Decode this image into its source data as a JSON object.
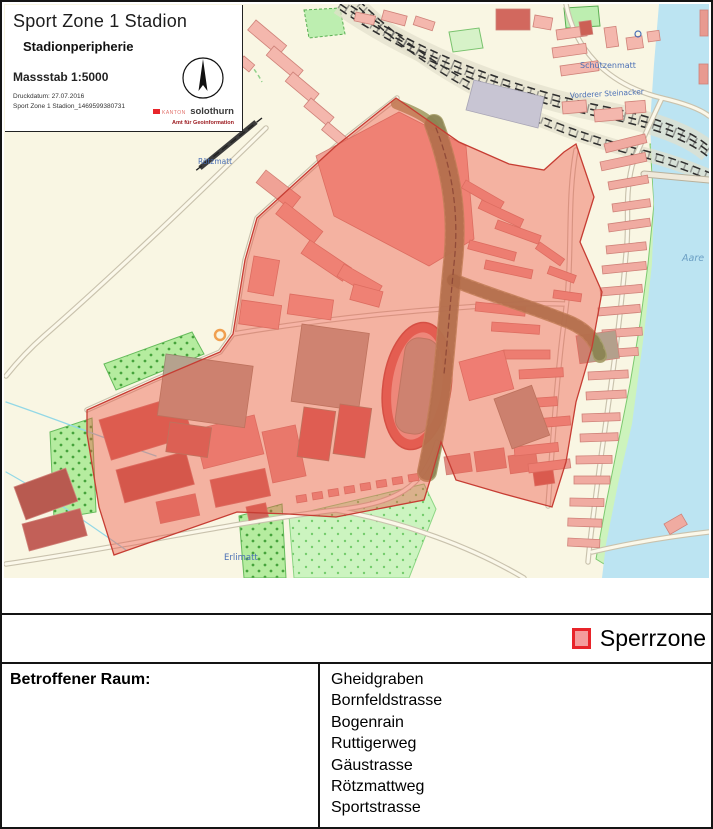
{
  "map": {
    "info_box": {
      "title": "Sport Zone 1 Stadion",
      "subtitle": "Stadionperipherie",
      "scale": "Massstab 1:5000",
      "print_date": "Druckdatum: 27.07.2016",
      "file_name": "Sport Zone 1 Stadion_1469599380731",
      "logo_kanton": "KANTON",
      "logo_name": "solothurn",
      "logo_dept": "Amt für Geoinformation"
    },
    "labels": {
      "schuetzenmatt": "Schützenmatt",
      "vorderer_steinacker": "Vorderer Steinacker",
      "roetzmatt": "Rötzmatt",
      "erlimatt": "Erlimatt",
      "aare": "Aare"
    },
    "colors": {
      "background": "#f9f6e3",
      "sperrzone_fill": "#ee5346",
      "sperrzone_border": "#c63d33",
      "river": "#bce4f2",
      "riverbank_green": "#cdf3bc",
      "building_salmon": "#f4b7ad",
      "building_dark_red": "#cf665c",
      "orchard_green": "#b5ec9f",
      "railway": "#2e2e2e"
    }
  },
  "legend": {
    "items": [
      {
        "label": "Sperrzone",
        "swatch_fill": "#f49c9c",
        "swatch_border": "#e8242a"
      }
    ]
  },
  "affected_area": {
    "label": "Betroffener Raum:",
    "streets": [
      "Gheidgraben",
      "Bornfeldstrasse",
      "Bogenrain",
      "Ruttigerweg",
      "Gäustrasse",
      "Rötzmattweg",
      "Sportstrasse"
    ]
  }
}
